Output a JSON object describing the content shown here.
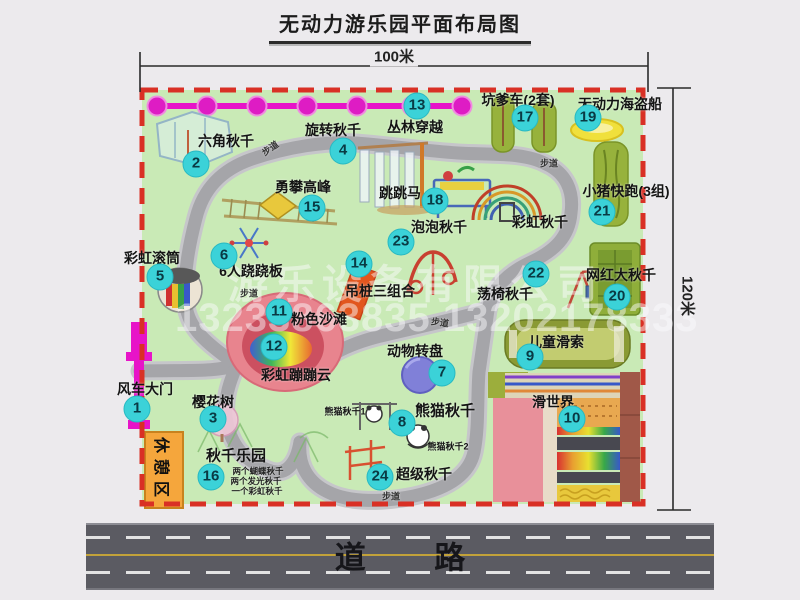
{
  "title": "无动力游乐园平面布局图",
  "dims": {
    "w": "100米",
    "h": "120米"
  },
  "road": {
    "label": "道 路"
  },
  "watermark": {
    "company": "游乐设备有限公司",
    "phone": "13233863835 13202178333"
  },
  "labels": {
    "path": "步道",
    "rest": "休憩区",
    "rainbow_swing": "彩虹秋千",
    "panda1": "熊猫秋千1",
    "panda2": "熊猫秋千2",
    "note1": "两个蝴蝶秋千",
    "note2": "两个发光秋千",
    "note3": "一个彩虹秋千"
  },
  "atr": {
    "1": {
      "num": "1",
      "name": "风车大门"
    },
    "2": {
      "num": "2",
      "name": "六角秋千"
    },
    "3": {
      "num": "3",
      "name": "樱花树"
    },
    "4": {
      "num": "4",
      "name": "旋转秋千"
    },
    "5": {
      "num": "5",
      "name": "彩虹滚筒"
    },
    "6": {
      "num": "6",
      "name": "6人跷跷板"
    },
    "7": {
      "num": "7",
      "name": "动物转盘"
    },
    "8": {
      "num": "8",
      "name": "熊猫秋千"
    },
    "9": {
      "num": "9",
      "name": "儿童滑索"
    },
    "10": {
      "num": "10",
      "name": "滑世界"
    },
    "11": {
      "num": "11",
      "name": "粉色沙滩"
    },
    "12": {
      "num": "12",
      "name": "彩虹蹦蹦云"
    },
    "13": {
      "num": "13",
      "name": "丛林穿越"
    },
    "14": {
      "num": "14",
      "name": "吊桩三组合"
    },
    "15": {
      "num": "15",
      "name": "勇攀高峰"
    },
    "16": {
      "num": "16",
      "name": "秋千乐园"
    },
    "17": {
      "num": "17",
      "name": "坑爹车(2套)"
    },
    "18": {
      "num": "18",
      "name": "跳跳马"
    },
    "19": {
      "num": "19",
      "name": "无动力海盗船"
    },
    "20": {
      "num": "20",
      "name": "网红大秋千"
    },
    "21": {
      "num": "21",
      "name": "小猪快跑(3组)"
    },
    "22": {
      "num": "22",
      "name": "荡椅秋千"
    },
    "23": {
      "num": "23",
      "name": "泡泡秋千"
    },
    "24": {
      "num": "24",
      "name": "超级秋千"
    }
  }
}
